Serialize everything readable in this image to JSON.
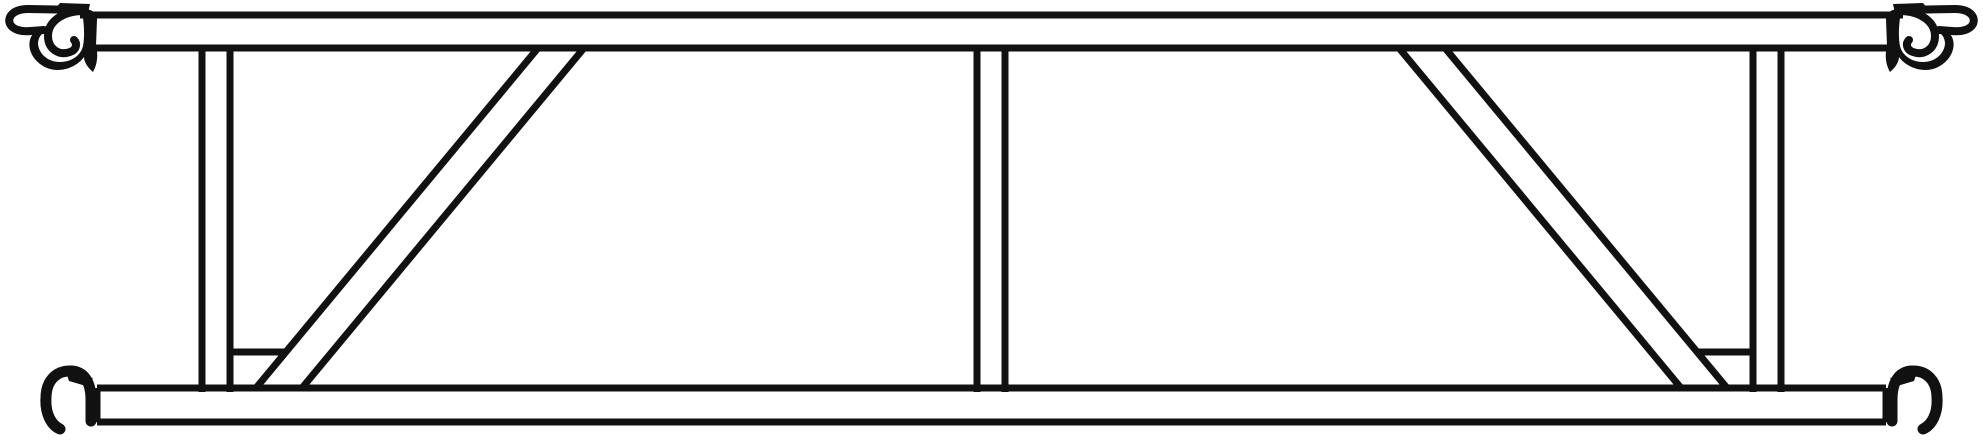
{
  "drawing": {
    "canvas": {
      "width": 1983,
      "height": 442
    },
    "ink": "#111111",
    "background": "#ffffff",
    "stroke_widths": {
      "member_line": 7,
      "hook_outline": 8,
      "hook_band": 11
    },
    "chords": [
      {
        "name": "top-ledger-tube",
        "lines": [
          [
            80,
            15,
            1903,
            15
          ],
          [
            95,
            48,
            1888,
            48
          ]
        ],
        "caps": []
      },
      {
        "name": "bottom-ledger-tube",
        "lines": [
          [
            97,
            388,
            1886,
            388
          ],
          [
            97,
            422,
            1886,
            422
          ]
        ],
        "caps": [
          [
            97,
            388,
            97,
            422
          ],
          [
            1886,
            388,
            1886,
            422
          ]
        ]
      }
    ],
    "posts": [
      {
        "name": "vertical-post-left",
        "lines": [
          [
            202,
            45,
            202,
            392
          ],
          [
            230,
            45,
            230,
            392
          ]
        ]
      },
      {
        "name": "vertical-post-center",
        "lines": [
          [
            977,
            45,
            977,
            392
          ],
          [
            1005,
            45,
            1005,
            392
          ]
        ]
      },
      {
        "name": "vertical-post-right",
        "lines": [
          [
            1753,
            45,
            1753,
            392
          ],
          [
            1781,
            45,
            1781,
            392
          ]
        ]
      }
    ],
    "diagonals": [
      {
        "name": "diagonal-brace-left",
        "lines": [
          [
            256,
            388,
            538,
            48
          ],
          [
            302,
            388,
            584,
            48
          ]
        ]
      },
      {
        "name": "diagonal-brace-right",
        "lines": [
          [
            1727,
            388,
            1445,
            48
          ],
          [
            1681,
            388,
            1399,
            48
          ]
        ]
      }
    ],
    "stubs": [
      {
        "name": "stub-connector-left",
        "line": [
          230,
          352,
          285,
          352
        ]
      },
      {
        "name": "stub-connector-right",
        "line": [
          1698,
          352,
          1753,
          352
        ]
      }
    ],
    "hooks": {
      "mirror_x": 1983,
      "top": {
        "silhouette": "M 83,8 C 93,10 97,13 97,19 L 96,46 C 98,54 98,63 93,72 C 88,68 84,62 84,57 C 76,68 60,73 47,68 C 33,62 26,48 31,37 C 34,31 39,28 45,27 L 47,31 C 41,33 38,38 38,44 C 39,54 48,62 60,62 C 72,62 81,55 83,46 C 85,37 84,22 82,12 Z",
        "flag": "M 55,9 L 60,3 L 90,4 L 88,13 Z",
        "beak": "M 84,10 L 28,9 C 13,9 7,17 10,24 C 13,30 22,32 31,31 L 44,30",
        "curl": "M 84,11 C 62,11 48,22 48,36 C 48,49 59,56 70,52 C 76,50 78,44 74,40"
      },
      "bottom": {
        "band": "M 91,421 L 91,400 C 91,382 84,372 72,371 C 56,370 46,381 46,398 C 45,413 51,425 60,429",
        "flag": "M 66,372 L 93,378 L 86,386 L 69,381 Z"
      },
      "instances": [
        {
          "type": "top",
          "name": "wedge-hook-top-left",
          "mirrored": false
        },
        {
          "type": "top",
          "name": "wedge-hook-top-right",
          "mirrored": true
        },
        {
          "type": "bottom",
          "name": "wedge-hook-bottom-left",
          "mirrored": false
        },
        {
          "type": "bottom",
          "name": "wedge-hook-bottom-right",
          "mirrored": true
        }
      ]
    }
  }
}
